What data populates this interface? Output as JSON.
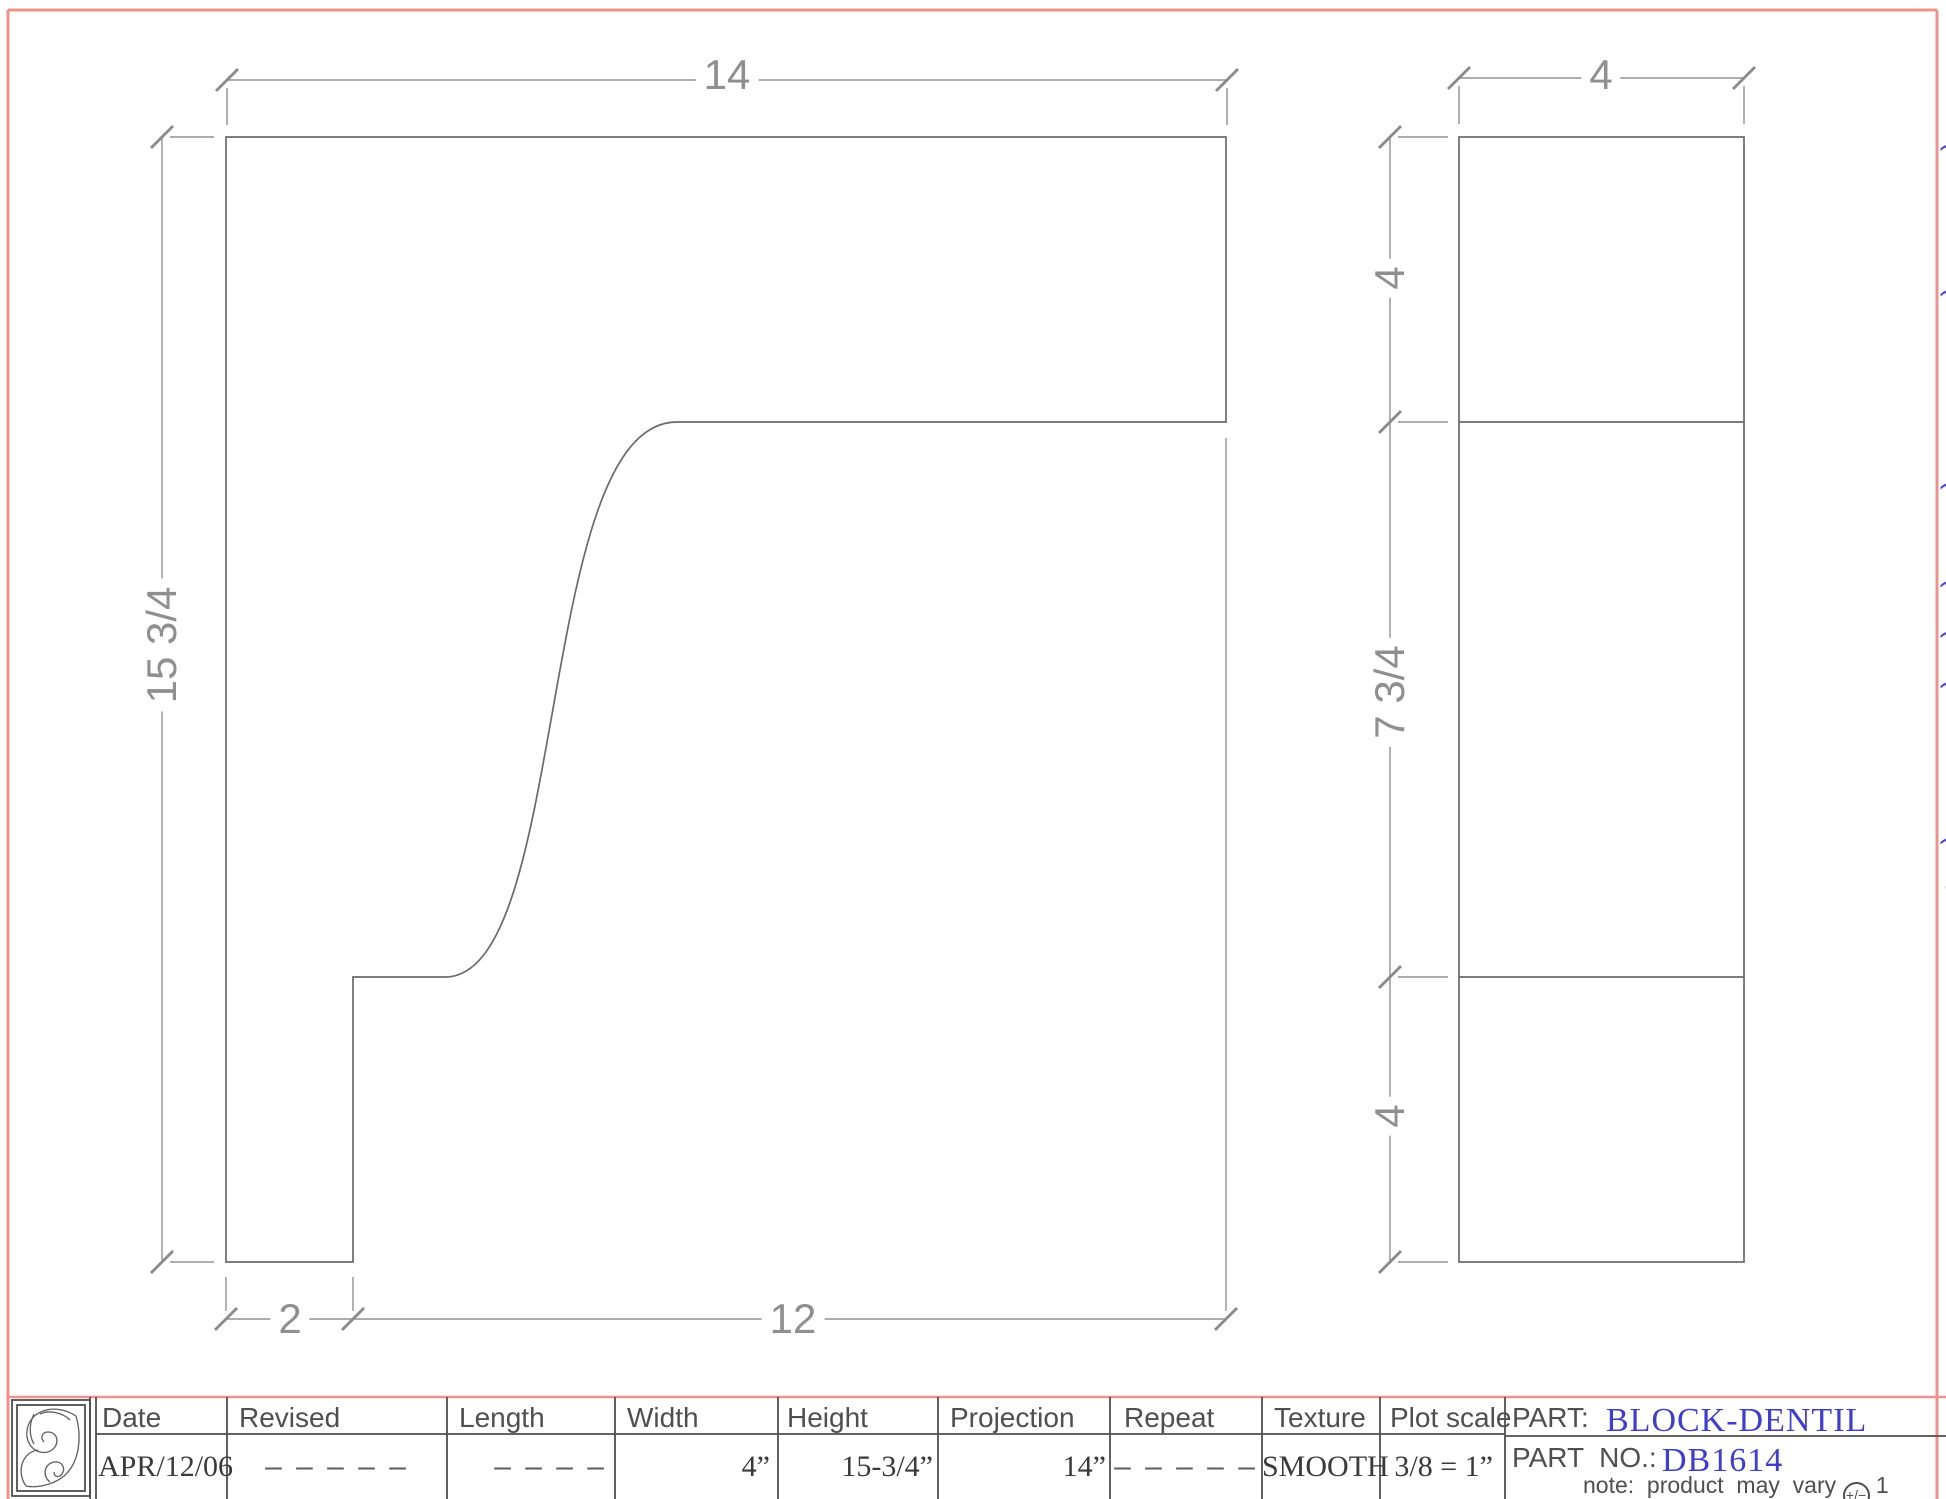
{
  "colors": {
    "page_border": "#f0928c",
    "object_lines": "#6a6a6a",
    "dimension_lines": "#8f8f8f",
    "table_lines": "#4f4f4f",
    "accent_blue": "#3d3dcf"
  },
  "front_view": {
    "dim_top": "14",
    "dim_left": "15 3/4",
    "dim_bottom_left": "2",
    "dim_bottom_right": "12"
  },
  "side_view": {
    "dim_top": "4",
    "dim_upper": "4",
    "dim_middle": "7 3/4",
    "dim_lower": "4"
  },
  "edge_text": "( l l ( l l l ( l ( ( ( F l ( / l l",
  "title_block": {
    "columns": [
      {
        "label": "Date",
        "value": "APR/12/06"
      },
      {
        "label": "Revised",
        "value": "– – – – –"
      },
      {
        "label": "Length",
        "value": "– – – –"
      },
      {
        "label": "Width",
        "value": "4”"
      },
      {
        "label": "Height",
        "value": "15-3/4”"
      },
      {
        "label": "Projection",
        "value": "14”"
      },
      {
        "label": "Repeat",
        "value": "– – – – –"
      },
      {
        "label": "Texture",
        "value": "SMOOTH"
      },
      {
        "label": "Plot scale",
        "value": "3/8 = 1”"
      }
    ],
    "part_label": "PART:",
    "part_value": "BLOCK-DENTIL",
    "part_no_label": "PART  NO.:",
    "part_no_value": "DB1614",
    "note": "note:  product  may  vary ",
    "note_tolerance": "+/−",
    "note_suffix": " 1"
  }
}
